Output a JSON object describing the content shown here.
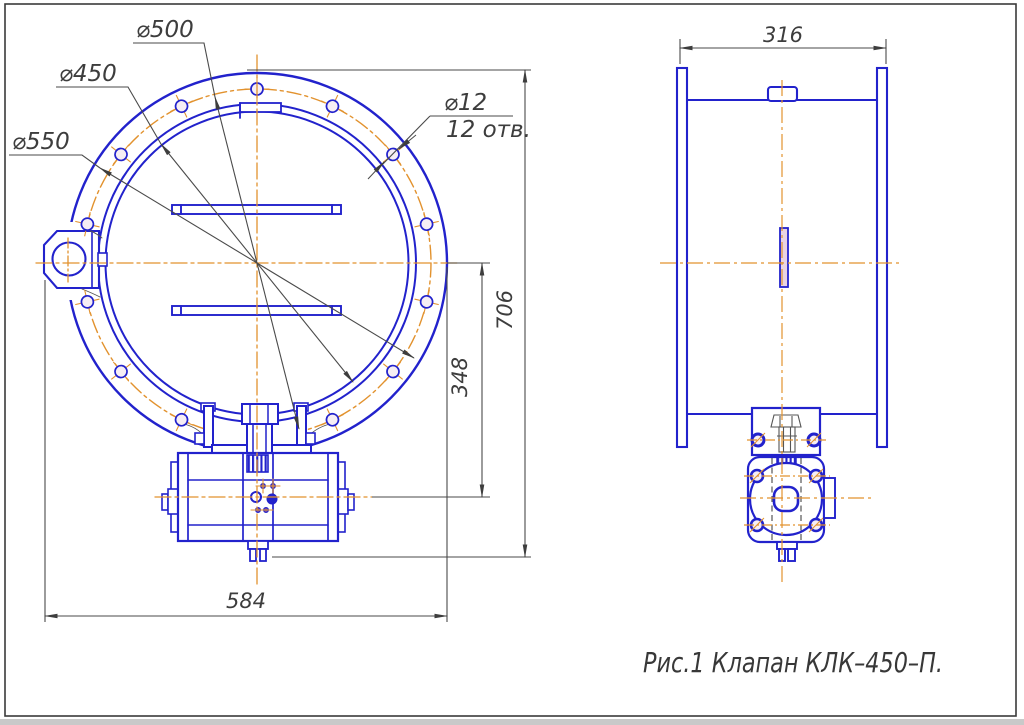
{
  "caption": "Рис.1 Клапан КЛК–450–П.",
  "front_view": {
    "diameter_labels": [
      {
        "id": "d500",
        "text": "⌀500"
      },
      {
        "id": "d450",
        "text": "⌀450"
      },
      {
        "id": "d550",
        "text": "⌀550"
      }
    ],
    "bolt_note": {
      "line1": "⌀12",
      "line2": "12 отв."
    },
    "bolt_holes": {
      "stated_count": "12",
      "hole_radius_px": 6,
      "circle_radius_px": 174,
      "center": {
        "x": 257,
        "y": 263
      },
      "angles_deg": [
        90,
        64.3,
        38.6,
        12.9,
        347.1,
        321.4,
        295.7,
        244.3,
        218.6,
        192.9,
        167.1,
        141.4,
        115.7
      ]
    },
    "dimensions": {
      "height_overall": "706",
      "center_to_actuator_axis": "348",
      "width_overall": "584"
    }
  },
  "side_view": {
    "dimensions": {
      "depth_overall": "316"
    }
  },
  "colors": {
    "line_blue": "#2222cc",
    "centerline_orange": "#e2922e",
    "dim_color": "#3d3d3d",
    "slot_fill": "#e9d3e2",
    "hole_fill": "#f6eef4"
  }
}
